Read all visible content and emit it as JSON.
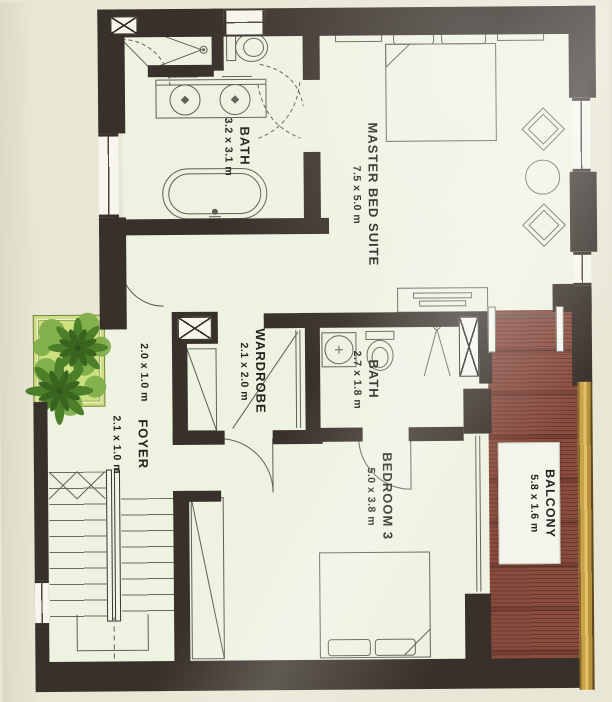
{
  "document": {
    "type": "architectural-floor-plan",
    "floor_label": "upper floor"
  },
  "rooms": {
    "master_suite": {
      "name": "MASTER BED SUITE",
      "dims": "7.5 x 5.0 m"
    },
    "bath_main": {
      "name": "BATH",
      "dims": "3.2 x 3.1 m"
    },
    "wardrobe": {
      "name": "WARDROBE",
      "dims": "2.1 x 2.0 m"
    },
    "bath_ensuite": {
      "name": "BATH",
      "dims": "2.7 x 1.8 m"
    },
    "bedroom3": {
      "name": "BEDROOM 3",
      "dims": "5.0 x 3.8 m"
    },
    "foyer": {
      "name": "FOYER",
      "dims": "2.1 x 1.0 m"
    },
    "balcony": {
      "name": "BALCONY",
      "dims": "5.8 x 1.6 m"
    },
    "planter": {
      "dims": "2.0 x 1.0 m"
    }
  },
  "colors": {
    "wall": "#38302a",
    "floor": "#eef2e1",
    "background": "#e8e6d4",
    "deck": "#8a4c3f",
    "railing_gold": "#c49e4a",
    "planter_box": "#cde07e",
    "plant_dark": "#3a651e",
    "plant_mid": "#4c7f2a",
    "plant_light": "#7fae4a",
    "line": "#5f5f56",
    "text": "#23211c"
  },
  "fixtures": [
    "double-bed",
    "bedside-tables",
    "lounge-chairs",
    "round-table",
    "dresser",
    "bathtub",
    "double-vanity",
    "toilet",
    "shower",
    "wash-basin",
    "single-bed",
    "closet",
    "staircase",
    "planter-plants",
    "sliding-doors"
  ]
}
